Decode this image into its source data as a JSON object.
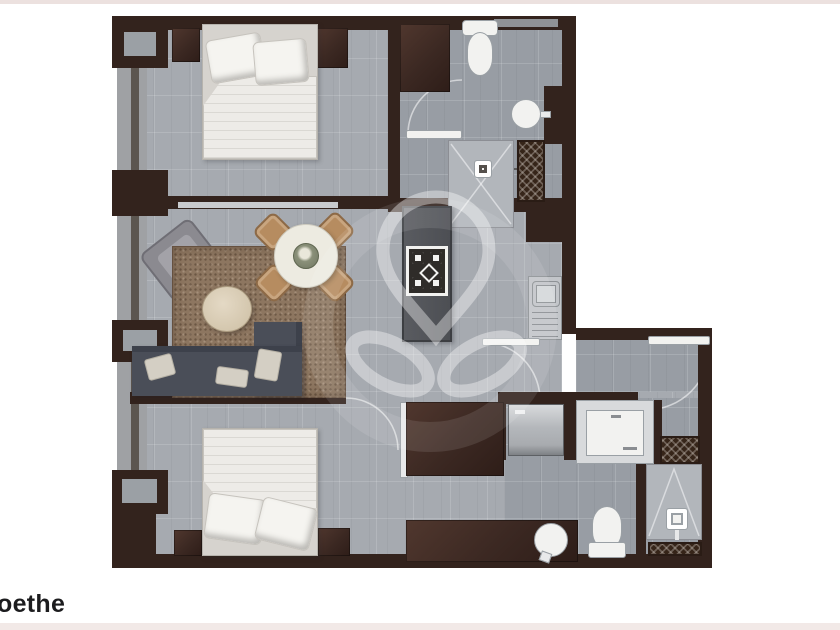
{
  "caption": {
    "text": "oethe"
  },
  "palette": {
    "background": "#ffffff",
    "top_strip": "#ece1df",
    "bottom_strip": "#f2e9e7",
    "wall": "#33231d",
    "wood_furniture": "#3b2822",
    "floor": "#a6aab0",
    "floor_dark": "#989da4",
    "rug": "#8d7660",
    "sofa": "#4a4e58",
    "bed_linen": "#edebe7",
    "dining_chair": "#b68c60",
    "fixture_white": "#f2f2f0",
    "watermark": "#ffffff"
  },
  "floorplan": {
    "type": "apartment-floor-plan",
    "watermark": {
      "shape": "map-pin-with-swirl-loops-and-ring",
      "opacity": 0.38
    },
    "rooms": [
      {
        "name": "bedroom-1",
        "position": "top-left",
        "fixtures": [
          "double-bed",
          "pillows",
          "nightstand-left",
          "nightstand-right",
          "wardrobe",
          "window-wall"
        ]
      },
      {
        "name": "bathroom-1-entry",
        "position": "top-right",
        "fixtures": [
          "toilet",
          "round-basin",
          "shower-stall",
          "shelf-unit-hatched",
          "door-swing"
        ]
      },
      {
        "name": "living-dining",
        "position": "center-left",
        "fixtures": [
          "armchair",
          "area-rug",
          "oval-coffee-table",
          "round-dining-table",
          "dining-chairs-x4",
          "sofa-with-chaise"
        ]
      },
      {
        "name": "kitchen",
        "position": "center-right",
        "fixtures": [
          "island-with-4-burner-cooktop",
          "sink-counter"
        ]
      },
      {
        "name": "bedroom-2",
        "position": "bottom-left",
        "fixtures": [
          "double-bed",
          "pillows",
          "nightstand-left",
          "nightstand-right",
          "window-wall"
        ]
      },
      {
        "name": "bathroom-2-laundry",
        "position": "bottom-right",
        "fixtures": [
          "closet",
          "washer",
          "white-appliance",
          "shelf-unit-hatched-upper",
          "vanity-with-round-basin",
          "toilet",
          "shower-stall",
          "shelf-unit-hatched-lower",
          "door-swings"
        ]
      }
    ]
  }
}
